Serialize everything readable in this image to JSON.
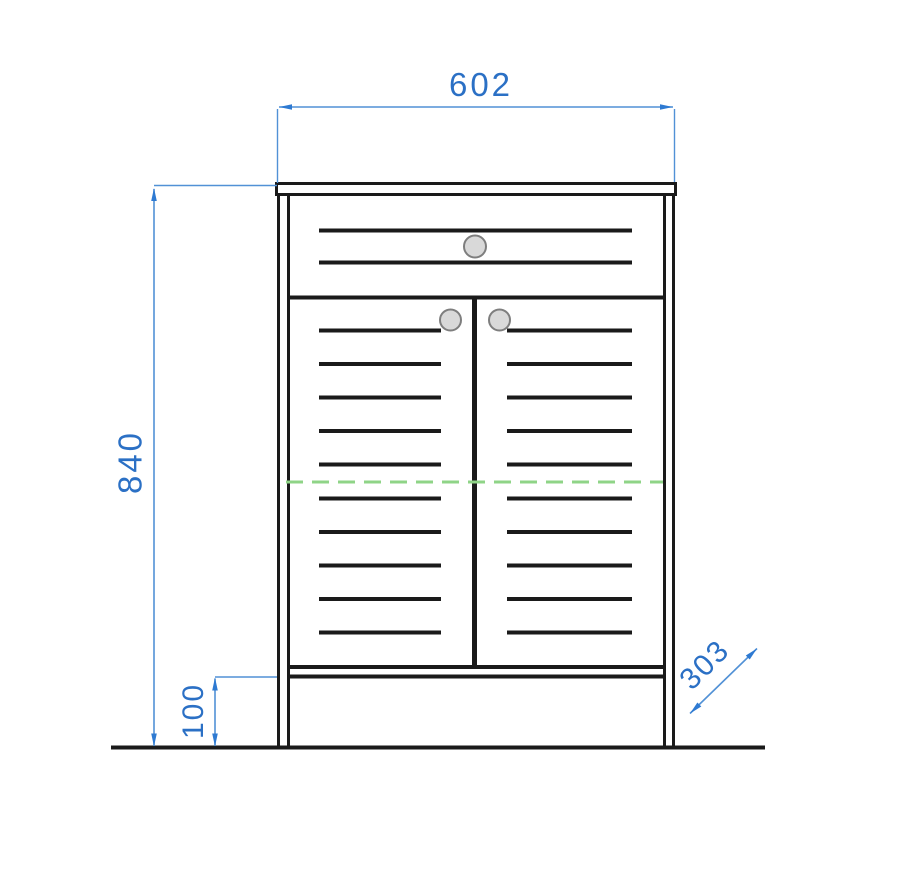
{
  "drawing": {
    "title": "Cabinet front elevation technical drawing",
    "object": "two-door cabinet with top drawer, slatted fronts and plinth",
    "dimensions": {
      "width": {
        "label": "602",
        "orientation": "horizontal-top"
      },
      "height": {
        "label": "840",
        "orientation": "vertical-left"
      },
      "plinth": {
        "label": "100",
        "orientation": "vertical-left-bottom"
      },
      "depth": {
        "label": "303",
        "orientation": "diagonal-45-bottom-right"
      }
    },
    "colors": {
      "line_black": "#1a1a1a",
      "dim_line_blue": "#5191d6",
      "dim_arrow_blue": "#2e7ad2",
      "dim_text_blue": "#2b70c5",
      "centerline_green": "#8fd487",
      "knob_fill": "#d9d9d9",
      "knob_stroke": "#7e7e7e",
      "background": "#ffffff"
    }
  }
}
